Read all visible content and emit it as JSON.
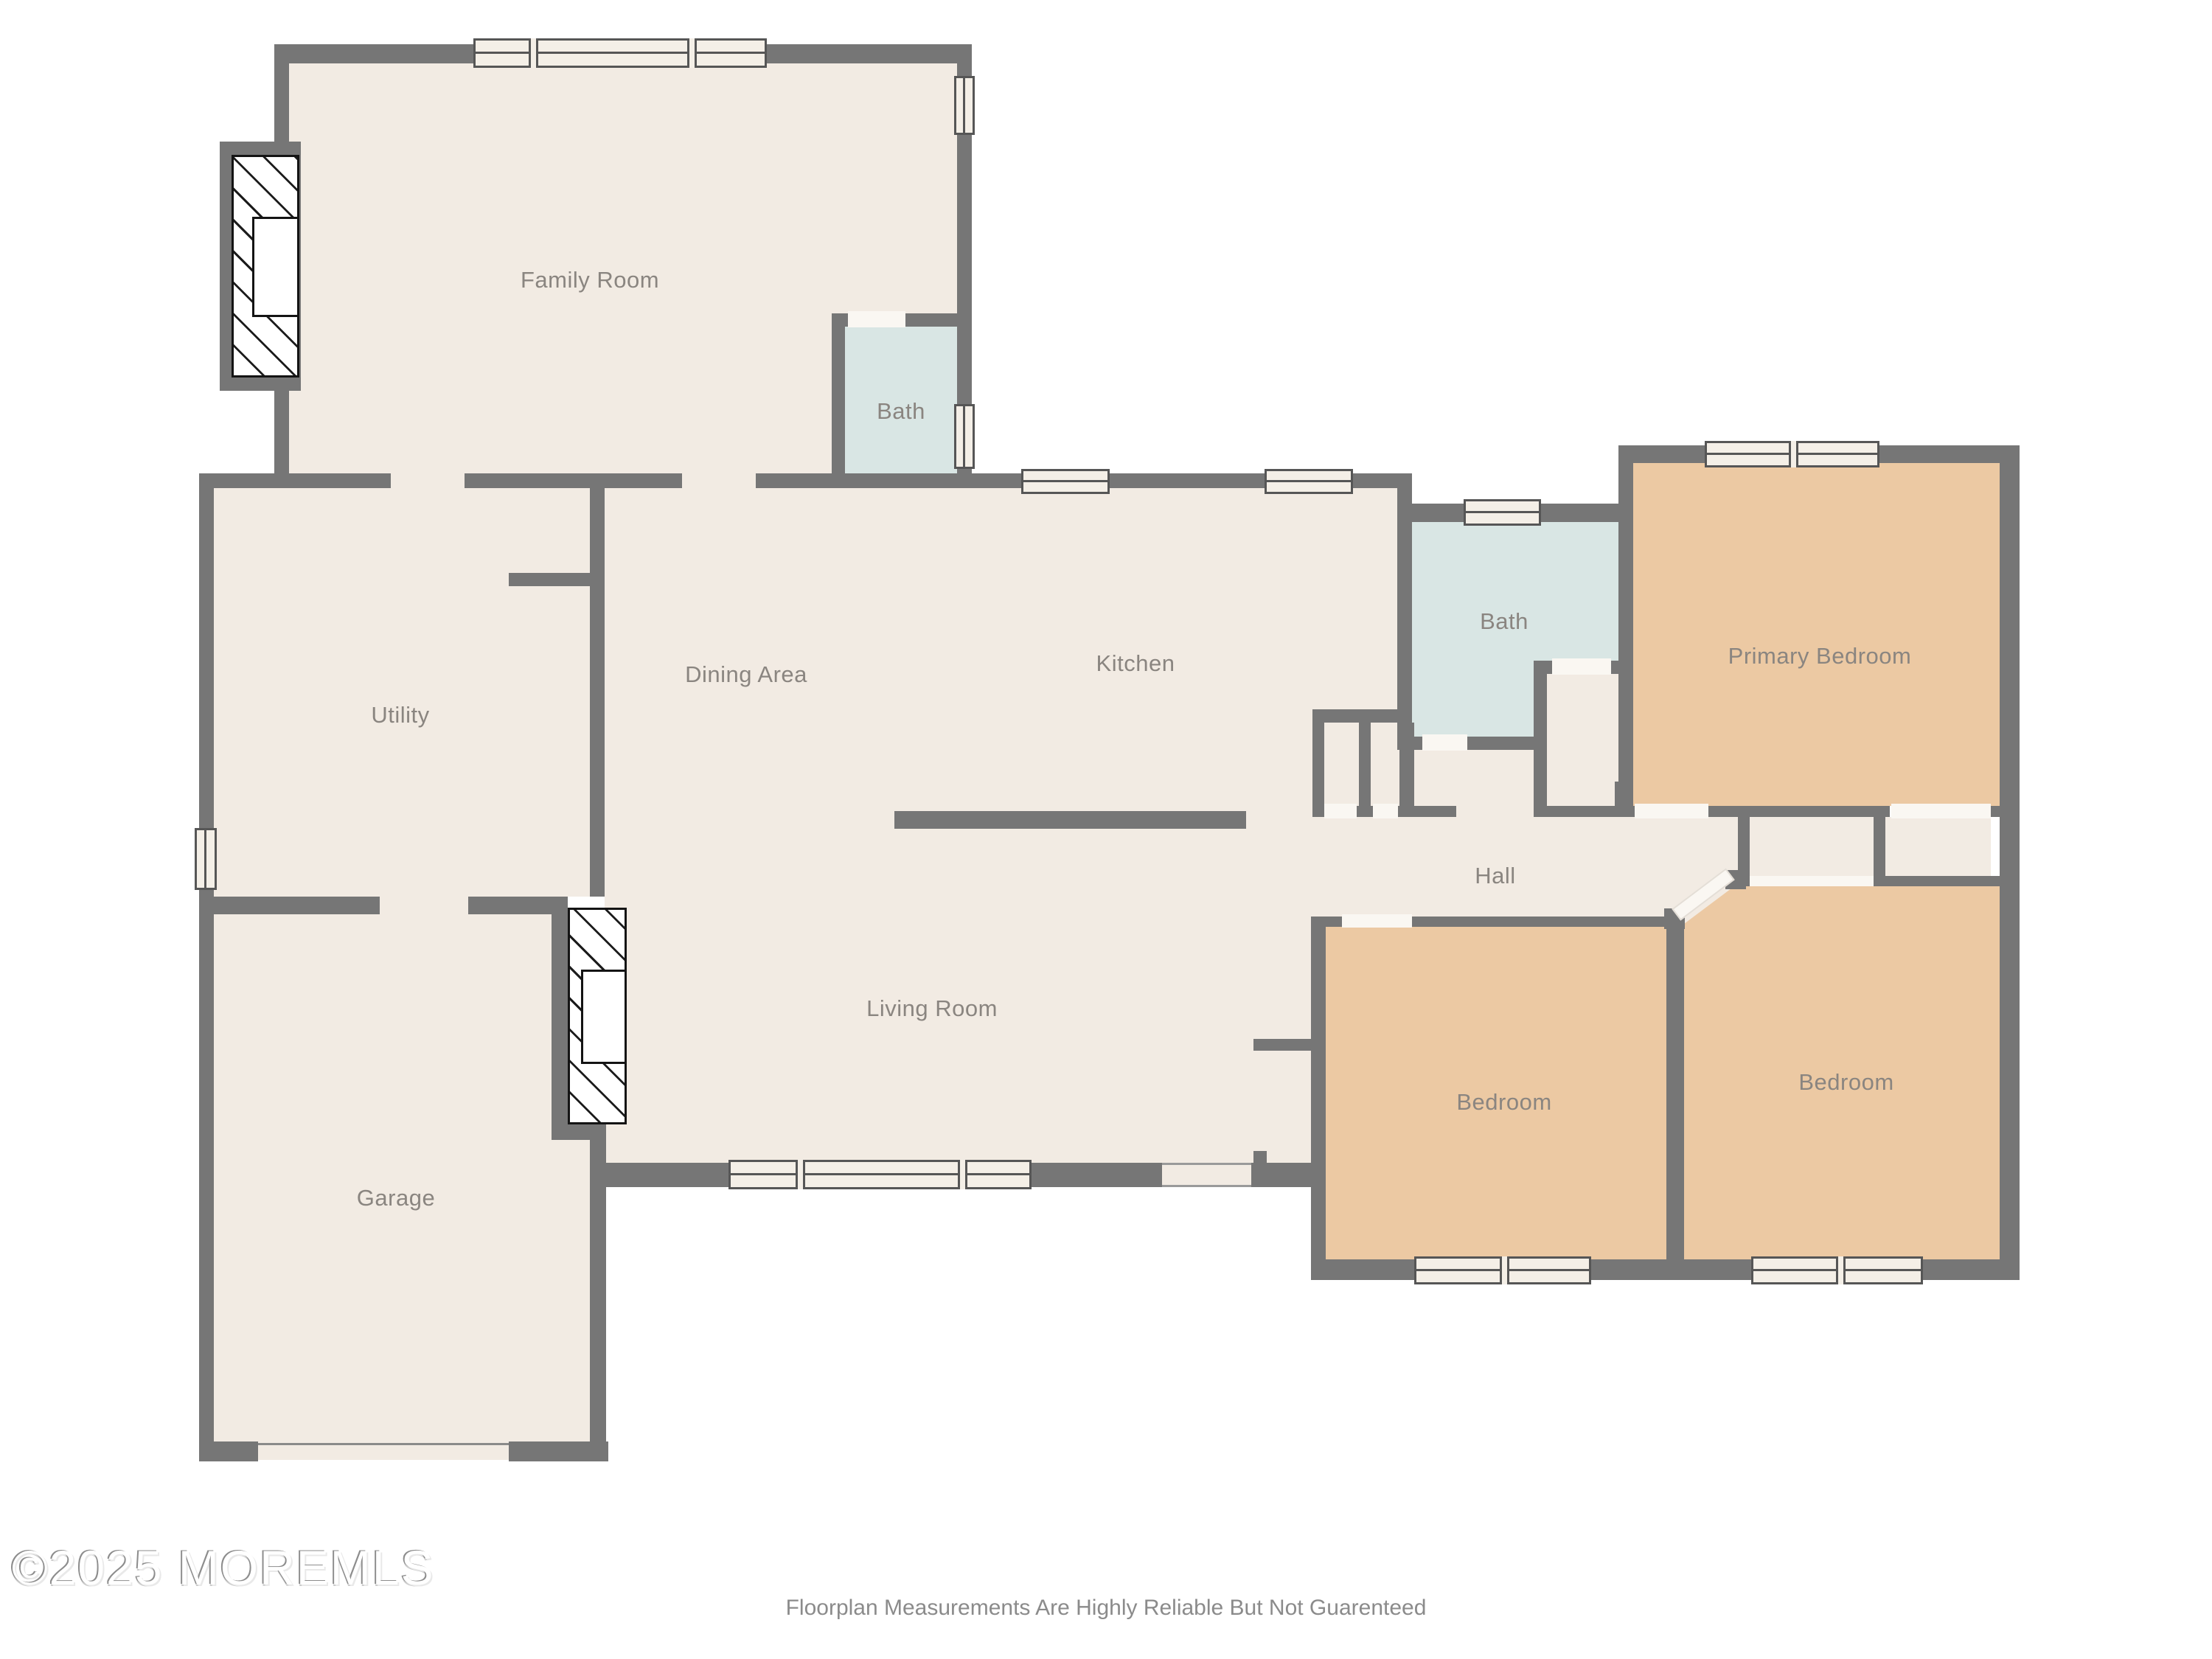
{
  "floorplan": {
    "rooms": [
      {
        "id": "family-room",
        "label": "Family Room"
      },
      {
        "id": "bath-upper",
        "label": "Bath"
      },
      {
        "id": "utility",
        "label": "Utility"
      },
      {
        "id": "dining-area",
        "label": "Dining Area"
      },
      {
        "id": "kitchen",
        "label": "Kitchen"
      },
      {
        "id": "bath-hall",
        "label": "Bath"
      },
      {
        "id": "primary-bedroom",
        "label": "Primary Bedroom"
      },
      {
        "id": "hall",
        "label": "Hall"
      },
      {
        "id": "living-room",
        "label": "Living Room"
      },
      {
        "id": "garage",
        "label": "Garage"
      },
      {
        "id": "bedroom-center",
        "label": "Bedroom"
      },
      {
        "id": "bedroom-right",
        "label": "Bedroom"
      }
    ],
    "colors": {
      "wall": "#767676",
      "floor": "#f2ebe3",
      "bedroom": "#ecc9a3",
      "bath": "#d9e6e4",
      "windowfill": "#f4efe7",
      "door": "#faf7f2",
      "label": "#8a8580"
    },
    "footer": {
      "copyright": "©2025 MOREMLS",
      "disclaimer": "Floorplan Measurements Are Highly Reliable But Not Guarenteed"
    }
  }
}
